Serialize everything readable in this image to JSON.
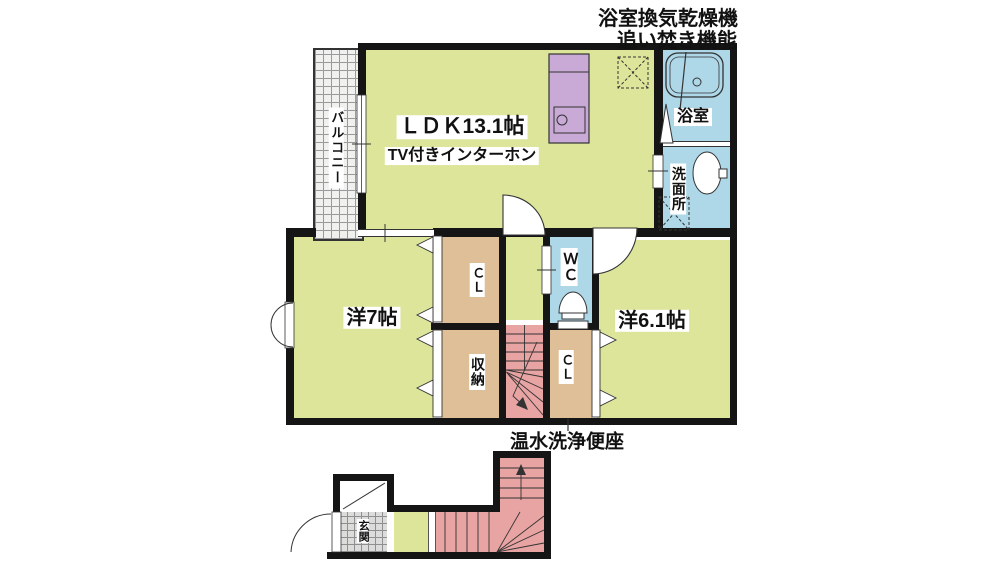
{
  "notes": {
    "bath_features_line1": "浴室換気乾燥機",
    "bath_features_line2": "追い焚き機能",
    "toilet_feature": "温水洗浄便座"
  },
  "floor2": {
    "balcony": "バルコニー",
    "ldk": "ＬＤＫ13.1帖",
    "ldk_note": "TV付きインターホン",
    "bathroom": "浴室",
    "washroom": "洗面所",
    "bedroom_left": "洋7帖",
    "bedroom_right": "洋6.1帖",
    "wc": "ＷＣ",
    "closet_left": "ＣＬ",
    "closet_right": "ＣＬ",
    "storage": "収納"
  },
  "floor1": {
    "entrance": "玄関"
  },
  "colors": {
    "room_green": "#dde59b",
    "closet_tan": "#debf98",
    "water_blue": "#aed7e8",
    "stairs_pink": "#e8a3a3",
    "kitchen_purple": "#c9a9d6",
    "wall_black": "#151515"
  }
}
